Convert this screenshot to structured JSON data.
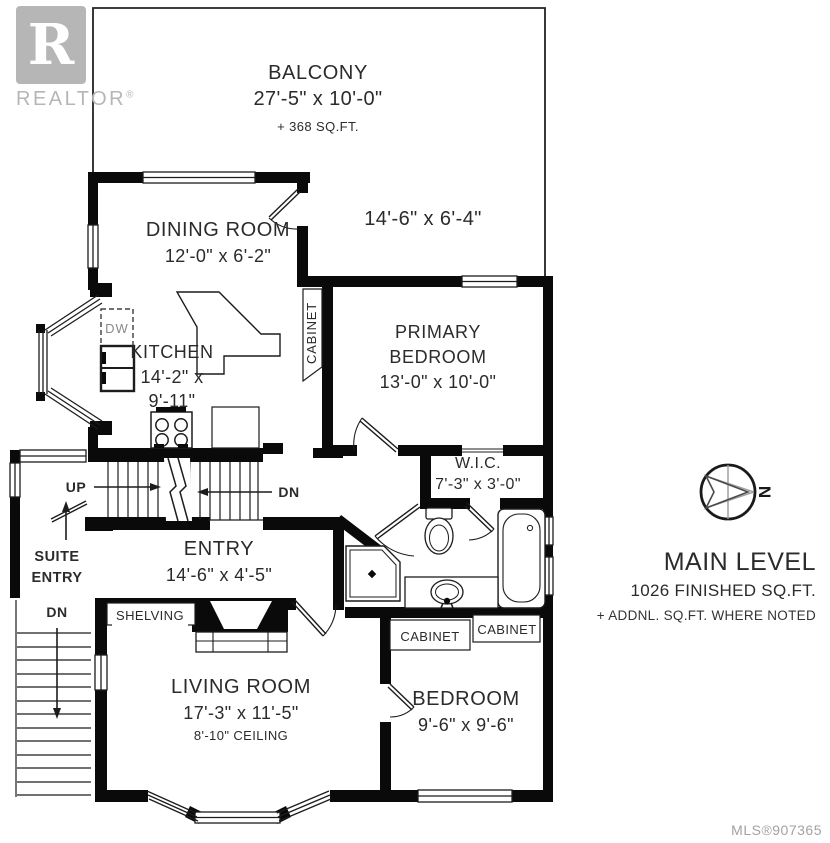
{
  "branding": {
    "logo_letter": "R",
    "logo_word": "REALTOR",
    "registered_mark": "®",
    "mls": "MLS®907365"
  },
  "title_block": {
    "title": "MAIN LEVEL",
    "area": "1026 FINISHED SQ.FT.",
    "note": "+ ADDNL. SQ.FT. WHERE NOTED",
    "compass_letter": "N"
  },
  "rooms": {
    "balcony": {
      "name": "BALCONY",
      "dims": "27'-5\" x 10'-0\"",
      "note": "+ 368 SQ.FT."
    },
    "balcony_ext": {
      "dims": "14'-6\" x 6'-4\""
    },
    "dining": {
      "name": "DINING ROOM",
      "dims": "12'-0\" x 6'-2\""
    },
    "kitchen": {
      "name": "KITCHEN",
      "dims_line1": "14'-2\" x",
      "dims_line2": "9'-11\""
    },
    "primary": {
      "name_line1": "PRIMARY",
      "name_line2": "BEDROOM",
      "dims": "13'-0\" x 10'-0\""
    },
    "wic": {
      "name": "W.I.C.",
      "dims": "7'-3\" x 3'-0\""
    },
    "entry": {
      "name": "ENTRY",
      "dims": "14'-6\" x 4'-5\""
    },
    "living": {
      "name": "LIVING ROOM",
      "dims": "17'-3\" x 11'-5\"",
      "note": "8'-10\" CEILING"
    },
    "bedroom": {
      "name": "BEDROOM",
      "dims": "9'-6\" x 9'-6\""
    }
  },
  "annotations": {
    "up": "UP",
    "dn_main": "DN",
    "dn_suite": "DN",
    "suite_entry_line1": "SUITE",
    "suite_entry_line2": "ENTRY",
    "shelving": "SHELVING",
    "dw": "DW",
    "cabinet_kitchen": "CABINET",
    "cabinet_bedroom_1": "CABINET",
    "cabinet_bedroom_2": "CABINET"
  }
}
